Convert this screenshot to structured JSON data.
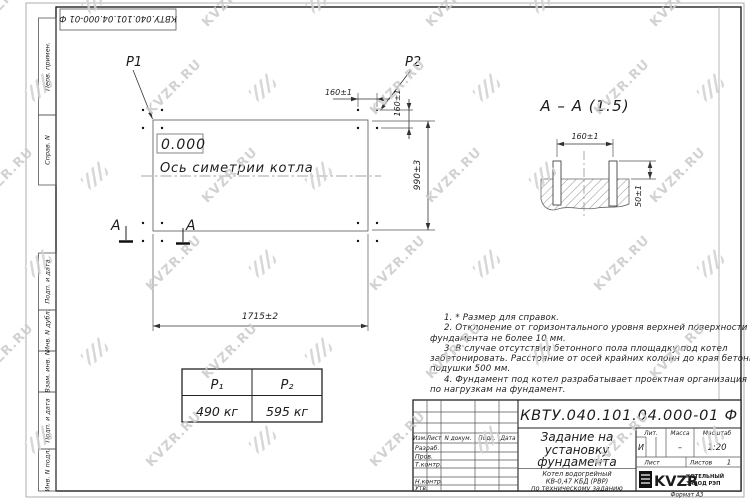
{
  "watermark": {
    "text": "KVZR.RU"
  },
  "frame": {
    "top_doc_number": "КВТУ.040.101.04.000-01 Ф",
    "format_label": "Формат А3",
    "sidebar_items": [
      "Перв. примен.",
      "Справ. N",
      "Подп. и дата",
      "Инв. N дубл.",
      "Взам. инв. N",
      "Подп. и дата",
      "Инв. N подл."
    ]
  },
  "plan": {
    "load_label_1": "P1",
    "load_label_2": "P2",
    "elevation_mark": "0.000",
    "axis_caption": "Ось симетрии котла",
    "dim_length": "1715±2",
    "dim_depth": "990±3",
    "dim_bolt_spacing_h": "160±1",
    "dim_bolt_spacing_v": "160±1",
    "section_letter_left": "А",
    "section_letter_right": "А"
  },
  "section_view": {
    "title": "А – А (1:5)",
    "dim_bolt_spacing": "160±1",
    "dim_bolt_height": "50±1"
  },
  "notes": {
    "lines": [
      "1. * Размер для справок.",
      "2. Отклонение от горизонтального уровня верхней поверхности",
      "фундамента не более 10 мм.",
      "3. В случае отсутствия бетонного пола площадку под котел",
      "забетонировать. Расстояние от осей крайних колонн до края бетонной",
      "подушки 500 мм.",
      "4. Фундамент под котел разрабатывает проектная организация",
      "по нагрузкам на фундамент."
    ]
  },
  "load_table": {
    "col1_header": "P₁",
    "col2_header": "P₂",
    "col1_value": "490 кг",
    "col2_value": "595 кг"
  },
  "title_block": {
    "doc_number": "КВТУ.040.101.04.000-01 Ф",
    "title_line1": "Задание на",
    "title_line2": "установку",
    "title_line3": "фундамента",
    "subtitle_line1": "Котел водогрейный",
    "subtitle_line2": "КВ-0,47 КБД (РВР)",
    "subtitle_line3": "по техническому заданию",
    "col_izm": "Изм.",
    "col_list": "Лист",
    "col_doc": "N докум.",
    "col_sign": "Подп.",
    "col_date": "Дата",
    "row_developed": "Разраб.",
    "row_checked": "Пров.",
    "row_tcontrol": "Т.контр.",
    "row_ncontrol": "Н.контр.",
    "row_approved": "Утв.",
    "lit_label": "Лит.",
    "mass_label": "Масса",
    "scale_label": "Масштаб",
    "lit_value": "И",
    "mass_value": "–",
    "scale_value": "1:20",
    "sheet_label": "Лист",
    "sheets_label": "Листов",
    "sheets_value": "1",
    "logo_text": "KVZR",
    "logo_caption_line1": "КОТЕЛЬНЫЙ",
    "logo_caption_line2": "ЗАВОД РЭП"
  }
}
